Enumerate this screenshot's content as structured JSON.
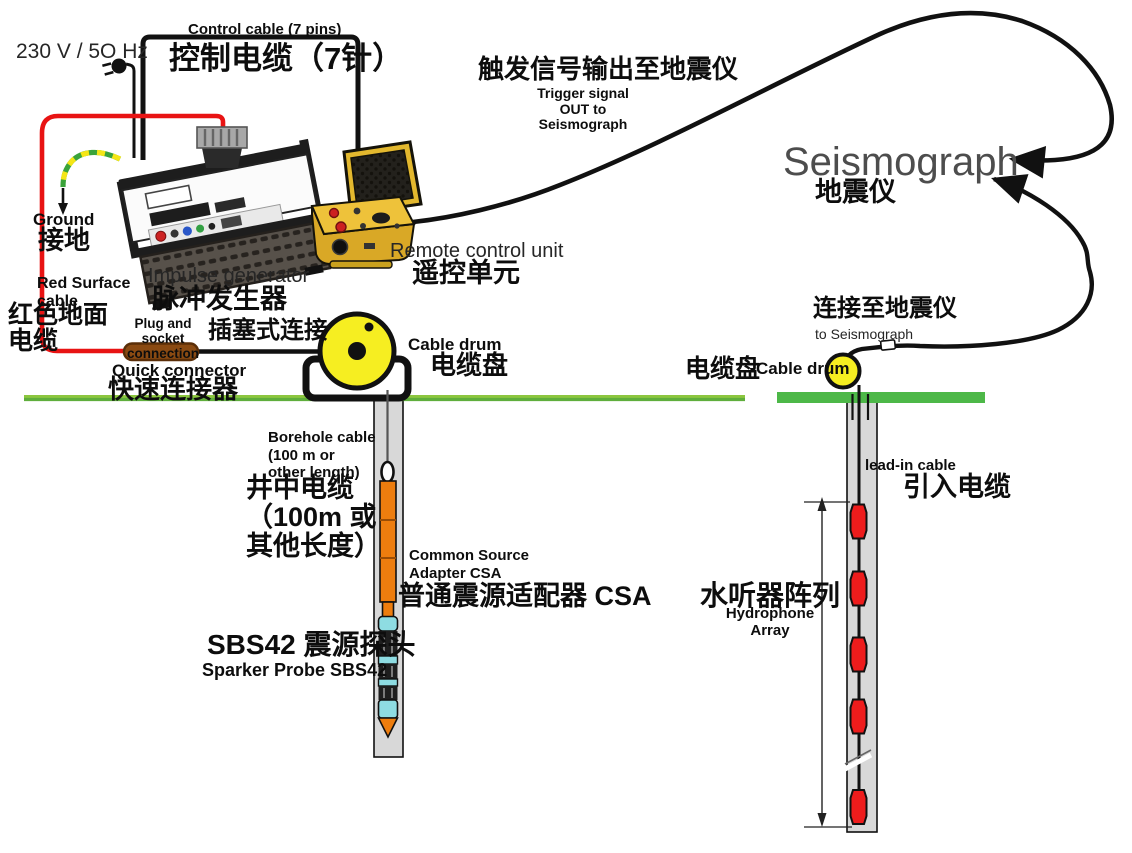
{
  "labels": {
    "power": "230 V / 5O Hz",
    "control_cable_en": "Control cable (7 pins)",
    "control_cable_zh": "控制电缆（7针）",
    "ground_en": "Ground",
    "ground_zh": "接地",
    "red_surface_en": "Red Surface\ncable",
    "red_surface_zh": "红色地面\n电缆",
    "impulse_en": "Impulse generator",
    "impulse_zh": "脉冲发生器",
    "plug_socket_en": "Plug and socket\nconnection",
    "plug_socket_zh": "插塞式连接",
    "quick_en": "Quick connector",
    "quick_zh": "快速连接器",
    "cable_drum_en": "Cable drum",
    "cable_drum_zh": "电缆盘",
    "rcu_en": "Remote control unit",
    "rcu_zh": "遥控单元",
    "trigger_zh": "触发信号输出至地震仪",
    "trigger_en": "Trigger signal\nOUT to\nSeismograph",
    "seismograph_en": "Seismograph",
    "seismograph_zh": "地震仪",
    "connect_zh": "连接至地震仪",
    "connect_en": "to Seismograph",
    "drum2_zh": "电缆盘",
    "drum2_en": "Cable drum",
    "leadin_en": "lead-in cable",
    "leadin_zh": "引入电缆",
    "hydrophone_zh": "水听器阵列",
    "hydrophone_en": "Hydrophone\nArray",
    "borehole_cable_en": "Borehole cable\n(100 m  or\nother length)",
    "borehole_cable_zh": "井中电缆\n（100m 或\n其他长度）",
    "csa_en": "Common Source\nAdapter CSA",
    "csa_zh": "普通震源适配器 CSA",
    "sbs42_zh": "SBS42 震源探头",
    "sbs42_en": "Sparker Probe SBS42"
  },
  "colors": {
    "cable_black": "#111111",
    "red_cable": "#e81313",
    "ground_green_left": "#6fbf44",
    "ground_green_right": "#4db848",
    "drum_yellow": "#f6ee21",
    "rcu_yellow": "#e3b82e",
    "foam_dark": "#23211c",
    "connector_brown": "#8a4a12",
    "borehole_gray": "#d8d8d8",
    "probe_orange": "#ed7d0e",
    "probe_cyan": "#8edce2",
    "hydrophone_red": "#ee1c1c",
    "seismograph_text_gray": "#4d4d4d",
    "ground_cable_green": "#3aa33a",
    "ground_cable_yellow": "#f5e616"
  }
}
